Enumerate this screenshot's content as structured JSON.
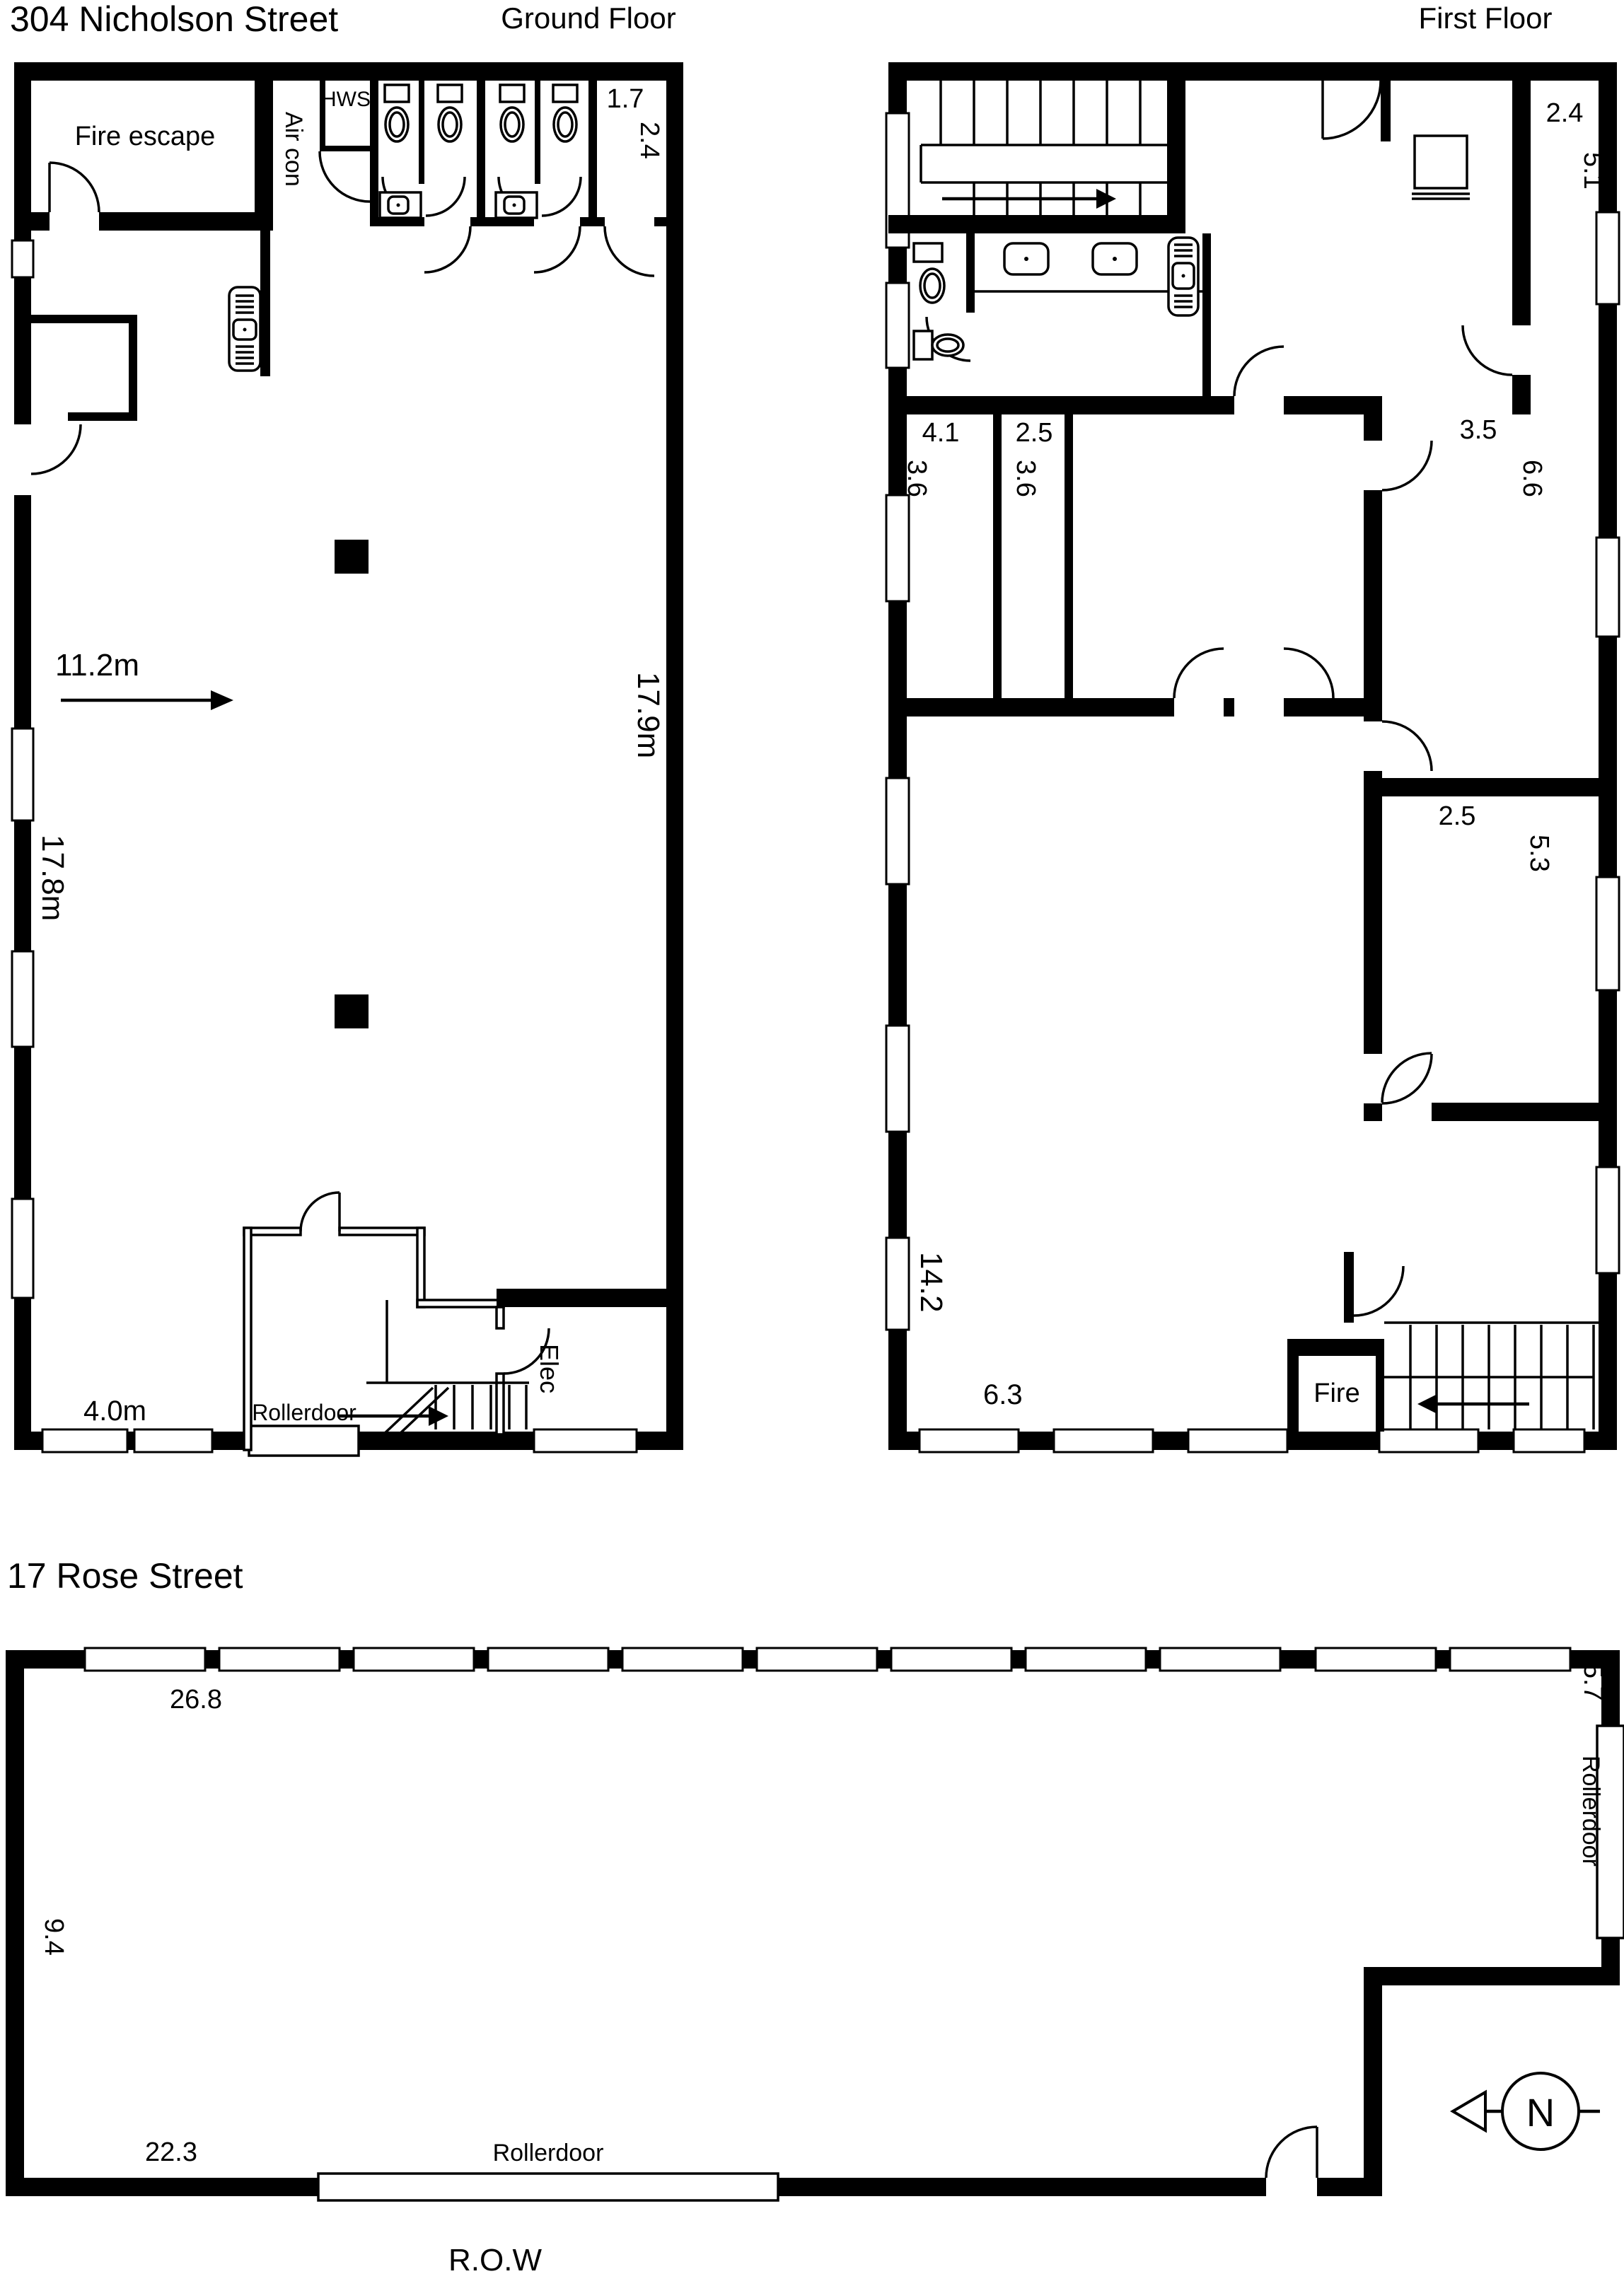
{
  "nicholson": {
    "title": "304 Nicholson Street",
    "ground_heading": "Ground Floor",
    "first_heading": "First Floor"
  },
  "ground": {
    "fire_escape": "Fire escape",
    "air_con": "Air con",
    "hws": "HWS",
    "room_17_w": "1.7",
    "room_17_d": "2.4",
    "dim_width": "11.2m",
    "dim_left": "17.8m",
    "dim_right": "17.9m",
    "dim_office": "4.0m",
    "rollerdoor": "Rollerdoor",
    "elec": "Elec"
  },
  "first": {
    "room_tr_w": "2.4",
    "room_tr_d": "5.1",
    "room_a_w": "4.1",
    "room_a_d": "3.6",
    "room_b_w": "2.5",
    "room_b_d": "3.6",
    "room_c_w": "3.5",
    "room_c_d": "6.6",
    "room_d_w": "2.5",
    "room_d_d": "5.3",
    "dim_depth": "14.2",
    "dim_bottom": "6.3",
    "fire": "Fire"
  },
  "rose": {
    "title": "17 Rose Street",
    "dim_top": "26.8",
    "dim_right_top": "5.7",
    "rollerdoor_right": "Rollerdoor",
    "dim_left": "9.4",
    "dim_bottom": "22.3",
    "rollerdoor_bottom": "Rollerdoor",
    "row": "R.O.W",
    "north": "N"
  }
}
